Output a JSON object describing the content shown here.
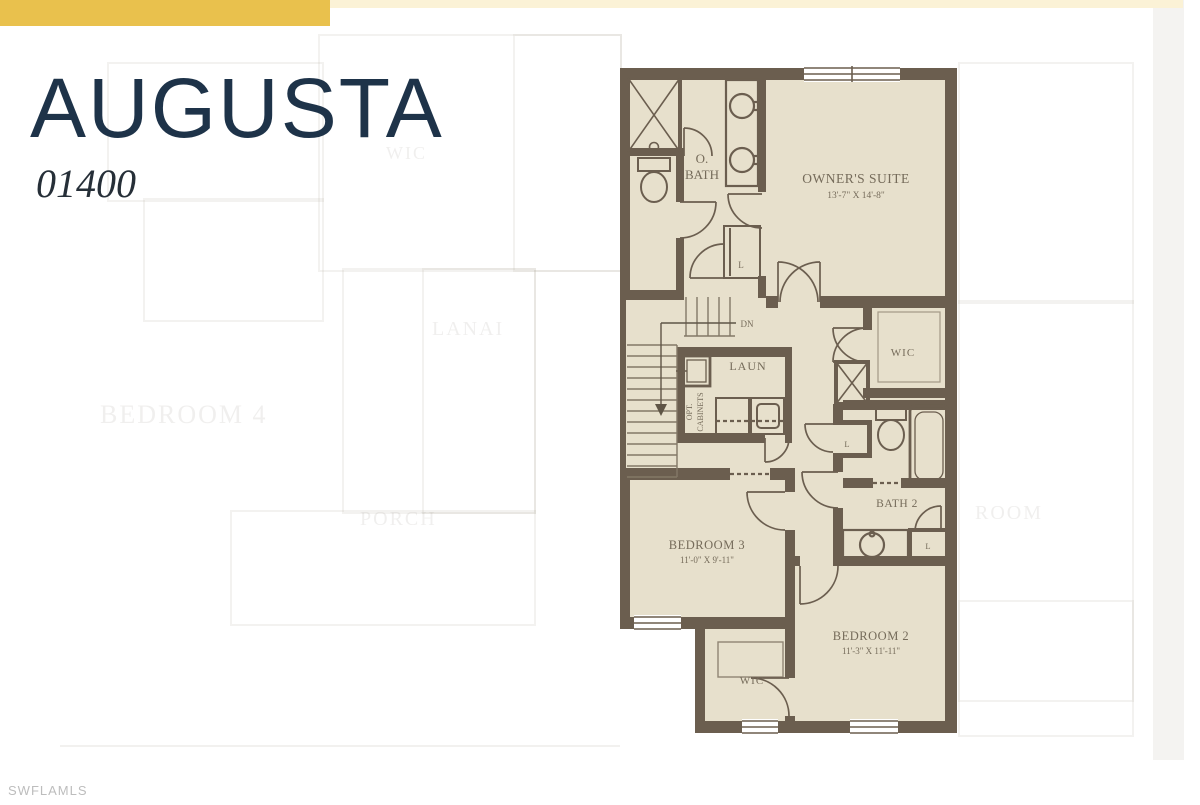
{
  "header": {
    "plan_name": "AUGUSTA",
    "plan_number": "01400"
  },
  "watermark": "SWFLAMLS",
  "colors": {
    "accent_gold": "#e9c14d",
    "accent_gold_pale": "#fbf2d6",
    "title_navy": "#1e3349",
    "wall": "#6b5e4f",
    "floor": "#e7e0cc",
    "plan_label": "#756b5a",
    "watermark_gray": "#bdbdbd"
  },
  "floor_plan": {
    "labels": {
      "o_bath_line1": "O.",
      "o_bath_line2": "BATH",
      "owners_suite": "OWNER'S SUITE",
      "owners_suite_dims": "13'-7\" X 14'-8\"",
      "linen_top": "L",
      "dn": "DN",
      "laundry": "LAUN",
      "opt_line1": "OPT.",
      "opt_line2": "CABINETS",
      "wic_upper": "WIC",
      "linen_hall": "L",
      "bath2": "BATH 2",
      "linen_bath2": "L",
      "bedroom3": "BEDROOM 3",
      "bedroom3_dims": "11'-0\" X 9'-11\"",
      "bedroom2": "BEDROOM 2",
      "bedroom2_dims": "11'-3\" X 11'-11\"",
      "wic_lower": "WIC"
    }
  },
  "ghost_plan": {
    "labels": [
      {
        "text": "BEDROOM 4"
      },
      {
        "text": "LANAI"
      },
      {
        "text": "PORCH"
      },
      {
        "text": "WIC"
      },
      {
        "text": "ROOM"
      }
    ]
  }
}
